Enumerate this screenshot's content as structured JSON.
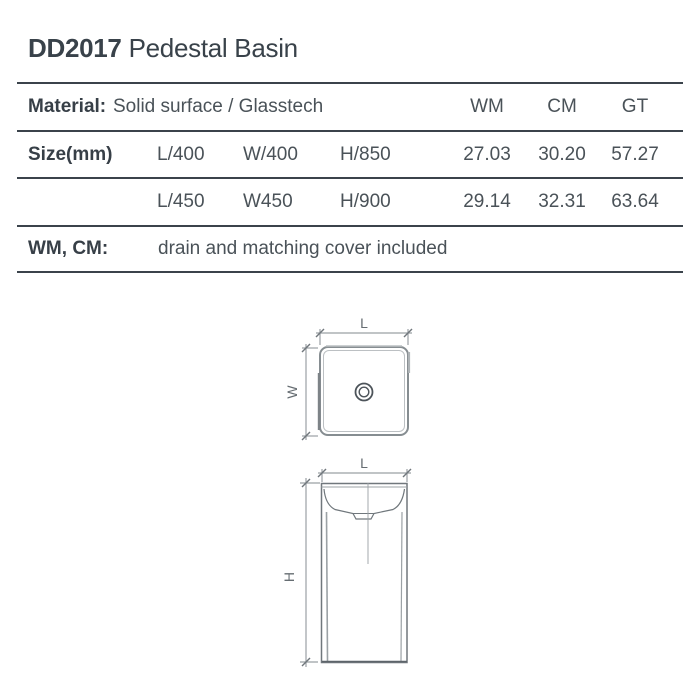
{
  "page": {
    "title_code": "DD2017",
    "title_name": "Pedestal Basin"
  },
  "table": {
    "material_label": "Material:",
    "material_value": "Solid surface / Glasstech",
    "col_headers": [
      "WM",
      "CM",
      "GT"
    ],
    "size_label": "Size(mm)",
    "rows": [
      {
        "l": "L/400",
        "w": "W/400",
        "h": "H/850",
        "wm": "27.03",
        "cm": "30.20",
        "gt": "57.27"
      },
      {
        "l": "L/450",
        "w": "W450",
        "h": "H/900",
        "wm": "29.14",
        "cm": "32.31",
        "gt": "63.64"
      }
    ],
    "note_label": "WM, CM:",
    "note_value": "drain and matching cover included"
  },
  "diagram": {
    "top_view": {
      "length_label": "L",
      "width_label": "W",
      "drain_icon": "concentric-circles"
    },
    "front_view": {
      "length_label": "L",
      "height_label": "H"
    }
  },
  "colors": {
    "text": "#4a5258",
    "heading": "#39424a",
    "rule": "#3b434b",
    "drawing_line": "#8f969a",
    "drawing_dark": "#70777c"
  }
}
